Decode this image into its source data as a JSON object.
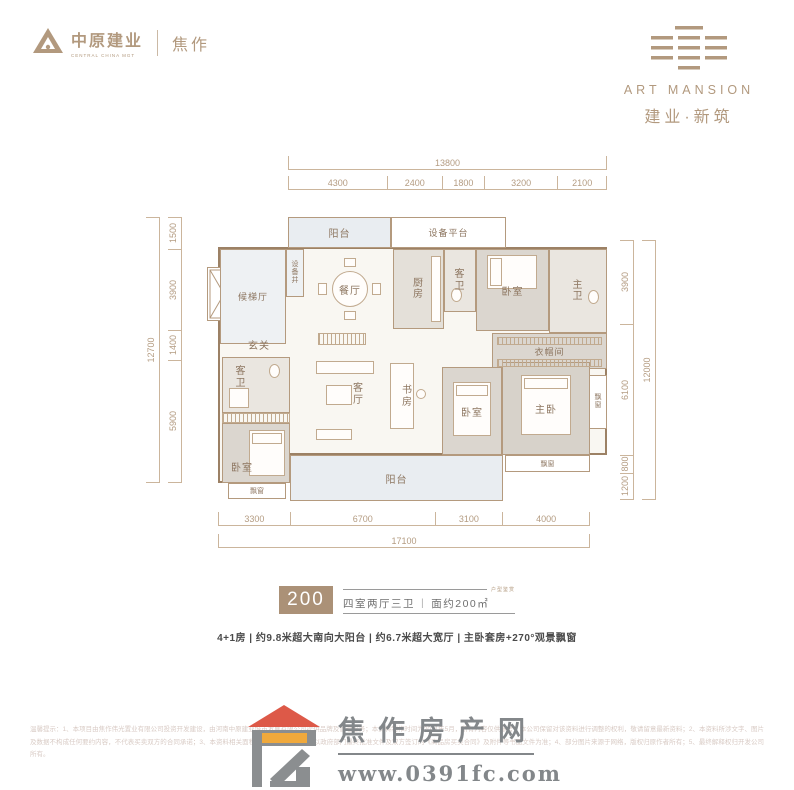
{
  "header": {
    "left": {
      "brand": "中原建业",
      "brand_en": "CENTRAL CHINA MGT",
      "city": "焦作"
    },
    "right": {
      "brand_en": "ART MANSION",
      "brand_cn": "建业·新筑"
    }
  },
  "floorplan": {
    "room_labels": {
      "balcony_top": "阳台",
      "equipment_platform": "设备平台",
      "equipment_shaft": "设备井",
      "elevator_hall": "候梯厅",
      "dining": "餐厅",
      "kitchen": "厨房",
      "guest_bath": "客卫",
      "bedroom": "卧室",
      "master_bath": "主卫",
      "foyer": "玄关",
      "closet": "衣帽间",
      "living": "客厅",
      "study": "书房",
      "master_bedroom": "主卧",
      "bay_window": "飘窗",
      "balcony_bottom": "阳台"
    },
    "dimensions": {
      "top": {
        "total": "13800",
        "segments": [
          "4300",
          "2400",
          "1800",
          "3200",
          "2100"
        ]
      },
      "bottom": {
        "total": "17100",
        "segments": [
          "3300",
          "6700",
          "3100",
          "4000"
        ]
      },
      "left": {
        "total": "12700",
        "segments": [
          "1500",
          "3900",
          "1400",
          "5900"
        ]
      },
      "right": {
        "total": "12000",
        "segments": [
          "3900",
          "6100",
          "800",
          "1200"
        ]
      }
    }
  },
  "title_block": {
    "unit_number": "200",
    "layout": "四室两厅三卫",
    "separator": "|",
    "area": "面约200㎡",
    "corner_text": "户型鉴赏"
  },
  "description": "4+1房 | 约9.8米超大南向大阳台 | 约6.7米超大宽厅 | 主卧套房+270°观景飘窗",
  "footer": {
    "site_name": "焦作房产网",
    "site_url": "www.0391fc.com",
    "disclaimer": "温馨提示：1、本项目由焦作伟光置业有限公司投资开发建设，由河南中原建业城市发展有限公司提供品牌及管理服务；本资料制作时间为2021年5月，所有内容仅供参考，本公司保留对该资料进行调整的权利，敬请留意最新资料；2、本资料所涉文字、图片及数据不构成任何要约内容，不代表买卖双方的合同承诺；3、本资料相关面积均为建筑面积，最终以政府部门最终批准文件及双方签订的《商品房买卖合同》及附件等书面文件为准；4、部分图片来源于网络，版权归原作者所有；5、最终解释权归开发公司所有。"
  },
  "colors": {
    "accent_tan": "#b2997e",
    "wall_line": "#b49a7e",
    "unit_box_bg": "#ab9177",
    "footer_gray": "#83878a",
    "roof_red": "#dd5948",
    "window_orange": "#f0a93c"
  }
}
